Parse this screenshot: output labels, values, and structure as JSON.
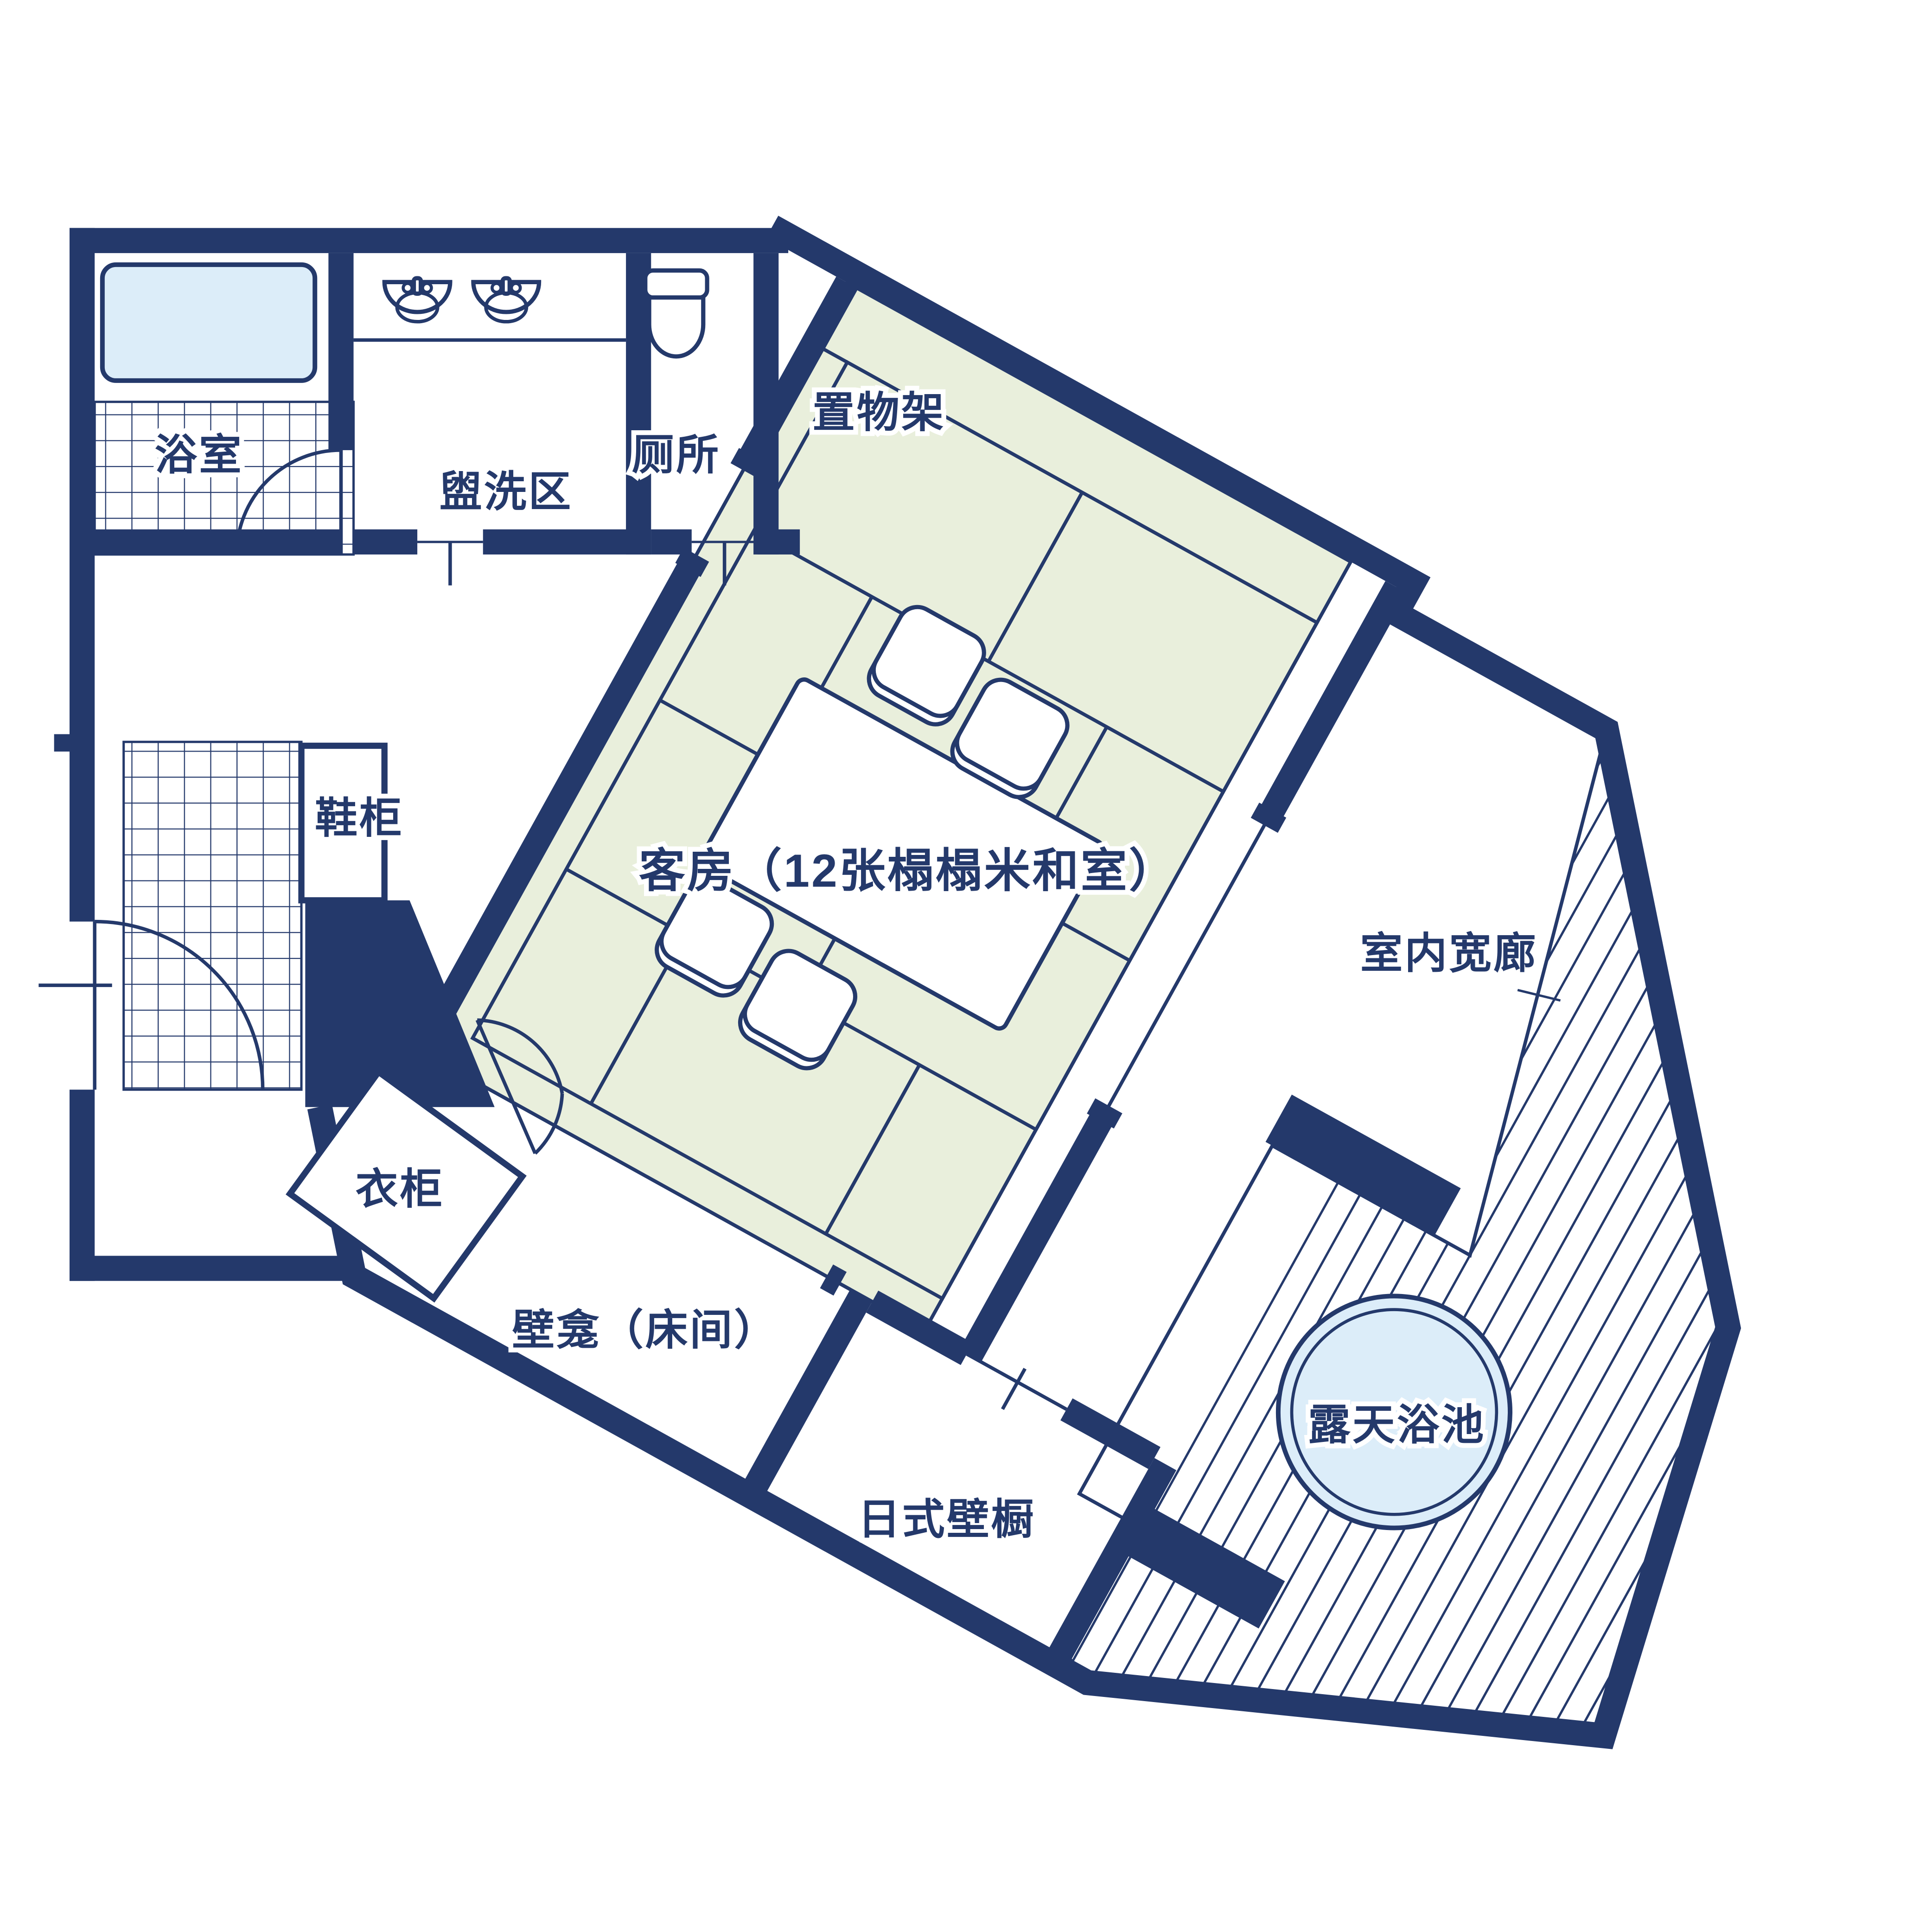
{
  "plan": {
    "type": "floorplan",
    "language": "zh",
    "rooms": {
      "bathroom": {
        "label": "浴室"
      },
      "washing_area": {
        "label": "盥洗区"
      },
      "toilet": {
        "label": "厕所"
      },
      "shelf": {
        "label": "置物架"
      },
      "shoe_cabinet": {
        "label": "鞋柜"
      },
      "guest_room": {
        "label": "客房（12张榻榻米和室）",
        "tatami_count": 12
      },
      "wardrobe": {
        "label": "衣柜"
      },
      "veranda": {
        "label": "室内宽廊"
      },
      "alcove": {
        "label": "壁龛（床间）"
      },
      "closet": {
        "label": "日式壁橱"
      },
      "open_air_bath": {
        "label": "露天浴池"
      }
    },
    "colors": {
      "navy": "#24396b",
      "tatami": "#e9efdc",
      "water": "#dcedf9",
      "white": "#ffffff"
    },
    "rotation_degrees": 29
  }
}
